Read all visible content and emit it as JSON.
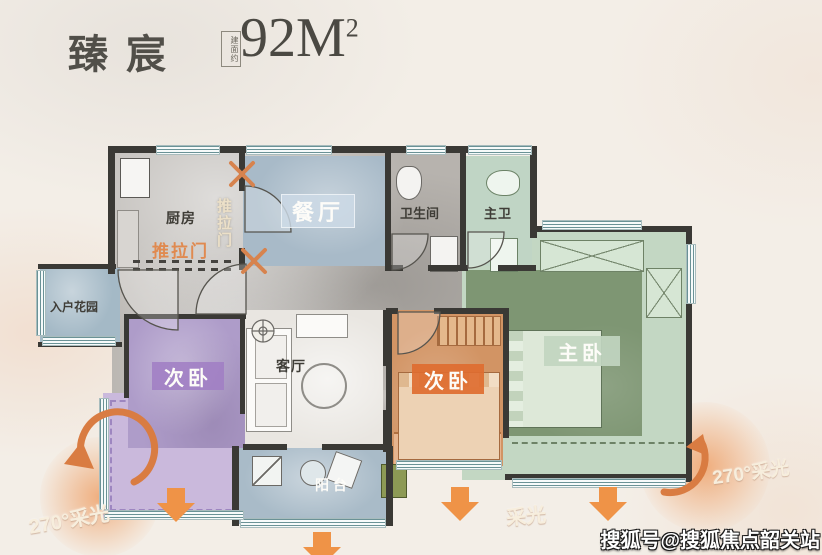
{
  "header": {
    "title": "臻宸",
    "area_note": "建面约",
    "area_value": "92M",
    "area_sup": "2"
  },
  "rooms": {
    "kitchen": "厨房",
    "dining": "餐厅",
    "bathroom": "卫生间",
    "master_bath": "主卫",
    "entry_garden": "入户花园",
    "bedroom_left": "次卧",
    "living": "客厅",
    "bedroom_right": "次卧",
    "master_bedroom": "主卧",
    "balcony": "阳台"
  },
  "annotations": {
    "sliding_door_h": "推拉门",
    "sliding_door_v": "推拉门",
    "light_left": "270°采光",
    "light_right": "270°采光",
    "light_bottom": "采光"
  },
  "watermark": "搜狐号@搜狐焦点韶关站",
  "colors": {
    "accent_orange": "#ef9347",
    "wall": "#3a3935",
    "dining_blue": "#a8bac8",
    "bedroom_purple": "#ae9cc9",
    "master_green_dark": "#7e9673",
    "master_green_light": "#c3d7c3",
    "bedroom_orange": "#d29464",
    "balcony_blue": "#a9bbc8",
    "corridor_gray": "#b7b3ae"
  }
}
